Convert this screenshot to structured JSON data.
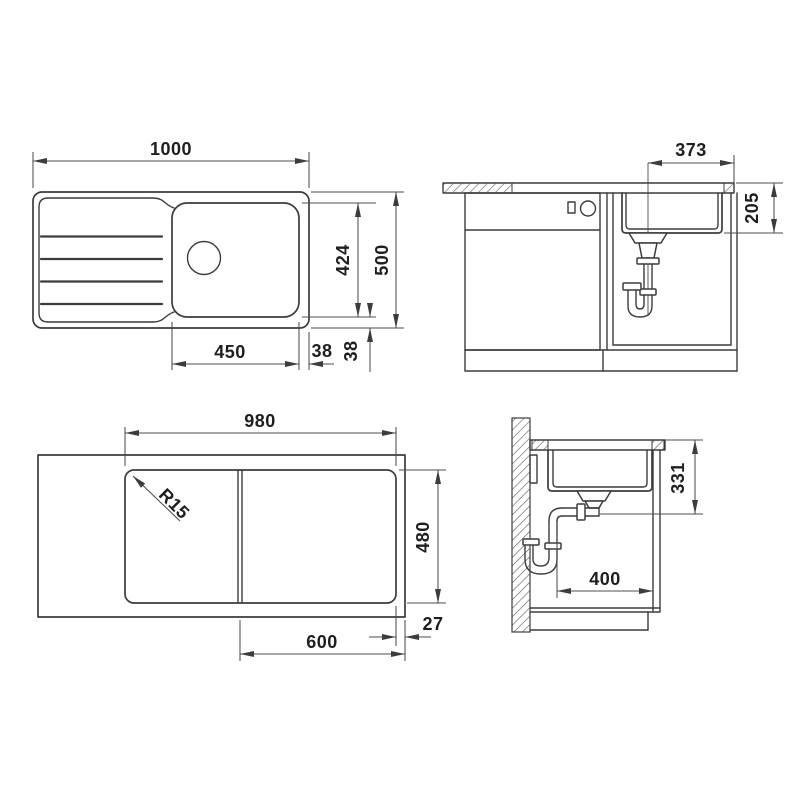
{
  "drawing": {
    "type": "technical-installation-drawing",
    "subject": "kitchen sink with drainboard - plan view, front section, worktop cutout and side section",
    "colors": {
      "line": "#3c3c3c",
      "dimension_line": "#4d4d4d",
      "text": "#1e1e1e",
      "background": "#ffffff"
    },
    "views": {
      "plan": {
        "label": "sink-plan-view",
        "dims": {
          "overall_width": "1000",
          "overall_depth": "500",
          "bowl_span": "424",
          "bowl_width": "450",
          "side_gap": "38",
          "front_gap": "38"
        }
      },
      "front_section": {
        "label": "front-section-view",
        "dims": {
          "drain_offset": "373",
          "bowl_depth": "205"
        }
      },
      "cutout": {
        "label": "worktop-cutout-view",
        "dims": {
          "cutout_width": "980",
          "cutout_depth": "480",
          "corner_radius": "R15",
          "cabinet_width": "600",
          "edge_offset": "27"
        }
      },
      "side_section": {
        "label": "side-section-view",
        "dims": {
          "outlet_height": "331",
          "outlet_depth": "400"
        }
      }
    }
  }
}
